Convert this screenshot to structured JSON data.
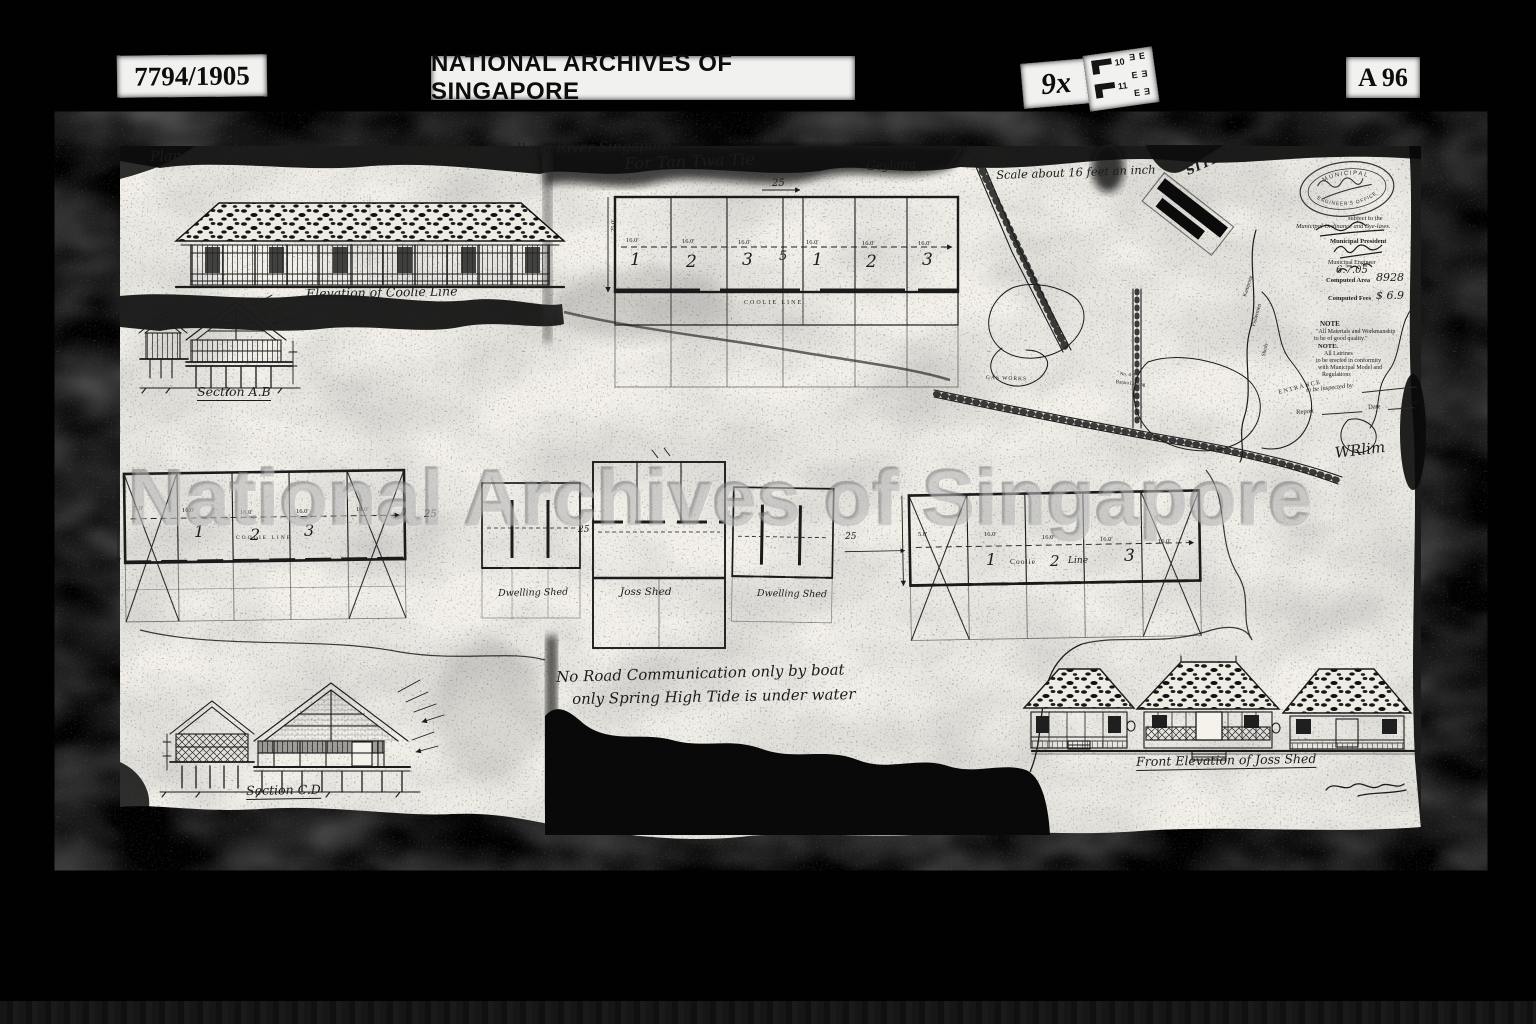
{
  "header": {
    "catalog_number": "7794/1905",
    "archive_name": "NATIONAL ARCHIVES OF SINGAPORE",
    "magnification": "9x",
    "reference_code": "A 96",
    "resolution_chart": {
      "num_top": "10",
      "num_bottom": "11",
      "letters": [
        "E",
        "E",
        "E",
        "E",
        "E",
        "E"
      ]
    }
  },
  "watermark": "National Archives of Singapore",
  "title": "Plan of Fishermen Sheds proposed to be built at Kallang River Singapore",
  "captions": {
    "coolie_elevation": "Elevation of Coolie Line",
    "section_ab": "Section A.B",
    "section_cd": "Section C.D",
    "joss_elevation": "Front Elevation of Joss Shed"
  },
  "notes": {
    "line1": "No Road Communication only by boat",
    "line2": "only Spring High Tide is under water"
  },
  "top_plan": {
    "dedication": "For Tan Twa Tie",
    "area_label": "Geylang",
    "scale_note": "Scale about 16 feet an inch",
    "width_dim": "25",
    "center_dim": "5",
    "bay_dim": "16.0'",
    "end_dim": "5.0'",
    "depth_dim": "25.0'",
    "bays": [
      "1",
      "2",
      "3",
      "1",
      "2",
      "3"
    ],
    "row_label": "COOLIE LINE"
  },
  "left_plan": {
    "bays": [
      "1",
      "2",
      "3"
    ],
    "row_label": "COOLIE LINE",
    "bay_dim": "16.0'",
    "end_dim": "5.0'",
    "gap_dim": "25"
  },
  "sheds": {
    "dwelling1": "Dwelling Shed",
    "joss": "Joss Shed",
    "dwelling2": "Dwelling Shed",
    "gap1": "25",
    "gap2": "25"
  },
  "right_plan": {
    "n1": "1",
    "w1": "Coolie",
    "n2": "2",
    "w2": "Line",
    "n3": "3",
    "bay_dim": "16.0'",
    "end_dim": "5.0'"
  },
  "map": {
    "site": "SITE",
    "gas_works": "GAS WORKS",
    "road_line1": "No. 4 B",
    "road_line2": "Batara Lagung",
    "bank_line1": "Kampong",
    "bank_line2": "Fishermen",
    "bank_line3": "Sheds",
    "entrance": "ENTRANCE",
    "stamp_top": "MUNICIPAL",
    "stamp_bottom": "ENGINEER'S OFFICE",
    "surveyor_signature": "WRlim",
    "approval": {
      "subject": "subject to the",
      "ordinance": "Municipal Ordinance and Bye-laws.",
      "president": "Municipal President",
      "engineer": "Municipal Engineer",
      "date": "6.7.05",
      "area_label": "Computed Area",
      "area_value": "8928",
      "fees_label": "Computed Fees",
      "fees_value": "$ 6.9",
      "note1_title": "NOTE",
      "note1_line1": "\"All Materials and Workmanship",
      "note1_line2": "to be of good quality.\"",
      "note2_title": "NOTE.",
      "note2_line1": "All Latrines",
      "note2_line2": "to be erected in conformity",
      "note2_line3": "with Municipal Model and",
      "note2_line4": "Regulations",
      "inspect": "to be inspected by",
      "report": "Report",
      "date_label": "Date",
      "asst": "Asst"
    }
  }
}
